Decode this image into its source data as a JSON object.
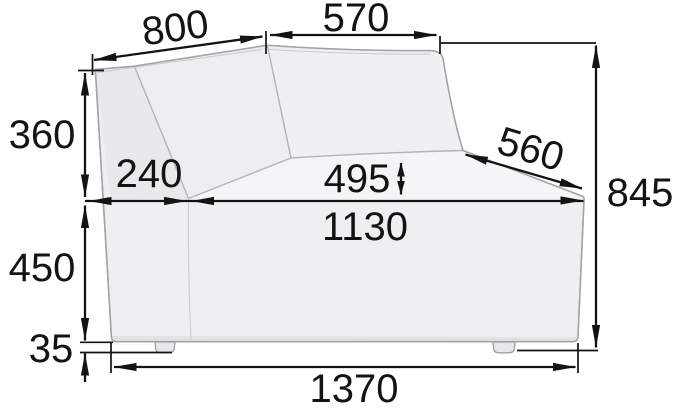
{
  "diagram": {
    "title": "sofa-corner-module-dimension-drawing",
    "colors": {
      "dimension_line": "#131313",
      "sofa_body": "#efeff1",
      "sofa_side_panel": "#e9e9eb",
      "sofa_seat": "#f5f5f7",
      "sofa_outline": "#a3a3a8",
      "background": "#ffffff"
    },
    "dimensions": {
      "back_left_width": {
        "label": "800"
      },
      "back_right_width": {
        "label": "570"
      },
      "backrest_height": {
        "label": "360"
      },
      "corner_depth": {
        "label": "240"
      },
      "seat_depth": {
        "label": "495"
      },
      "seat_width": {
        "label": "1130"
      },
      "base_height": {
        "label": "450"
      },
      "foot_height": {
        "label": "35"
      },
      "overall_width": {
        "label": "1370"
      },
      "side_seat_depth": {
        "label": "560"
      },
      "overall_height": {
        "label": "845"
      }
    }
  }
}
